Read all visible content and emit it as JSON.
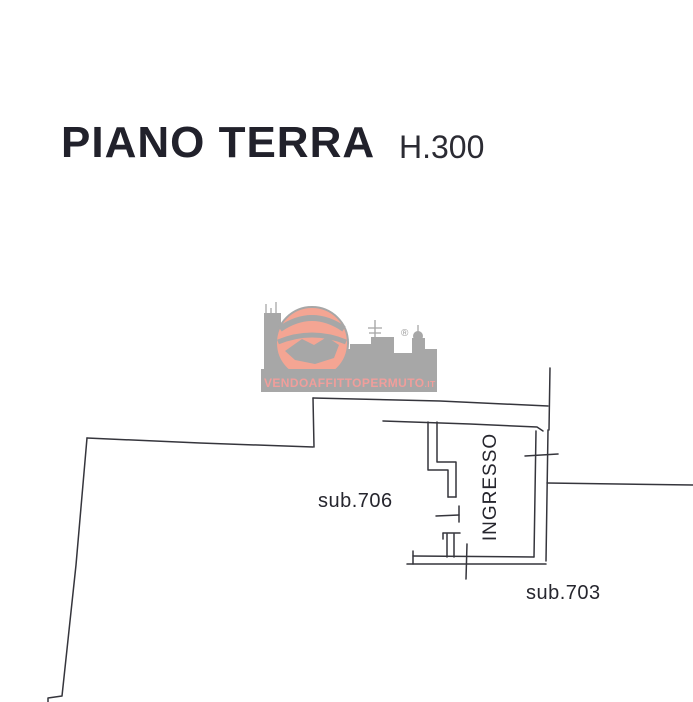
{
  "header": {
    "title": "PIANO TERRA",
    "height_label": "H.300"
  },
  "watermark": {
    "brand": "VENDOAFFITTOPERMUTO",
    "brand_suffix": ".IT",
    "registered_mark": "®",
    "colors": {
      "skyline_gray": "#a7a7a7",
      "globe_salmon": "#f4a593",
      "text_pink": "#f09e9b"
    }
  },
  "floorplan": {
    "line_color": "#35353c",
    "labels": [
      {
        "id": "sub706",
        "text": "sub.706"
      },
      {
        "id": "ingresso",
        "text": "INGRESSO"
      },
      {
        "id": "sub703",
        "text": "sub.703"
      }
    ]
  }
}
